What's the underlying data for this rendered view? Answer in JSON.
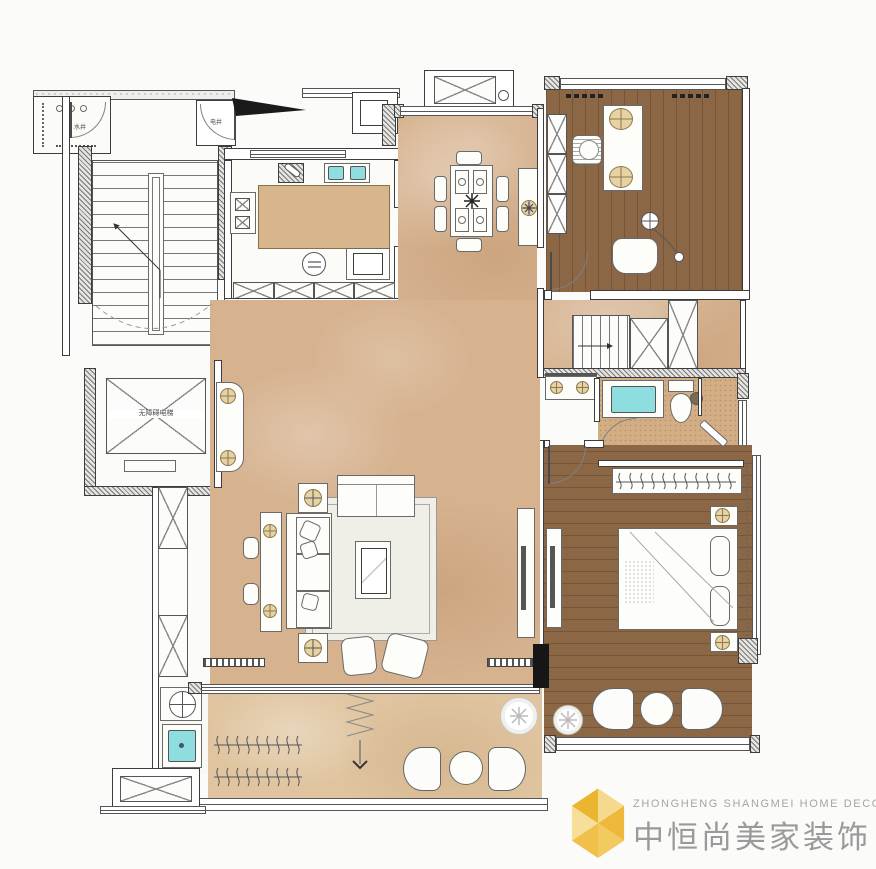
{
  "plan": {
    "labels": {
      "water_shaft": "水井",
      "electric_shaft": "电井",
      "elevator": "无障碍电梯"
    },
    "colors": {
      "floor_tan": "#d6b28f",
      "floor_stone": "#dfc49f",
      "floor_wood": "#8b6746",
      "fixture_cyan": "#8edee0",
      "wall_line": "#3d3d3d",
      "logo_gold": "#eec05a",
      "logo_text_gray": "#9c9c9c"
    }
  },
  "logo": {
    "en": "ZHONGHENG SHANGMEI HOME DECORATION",
    "cn": "中恒尚美家装饰"
  }
}
